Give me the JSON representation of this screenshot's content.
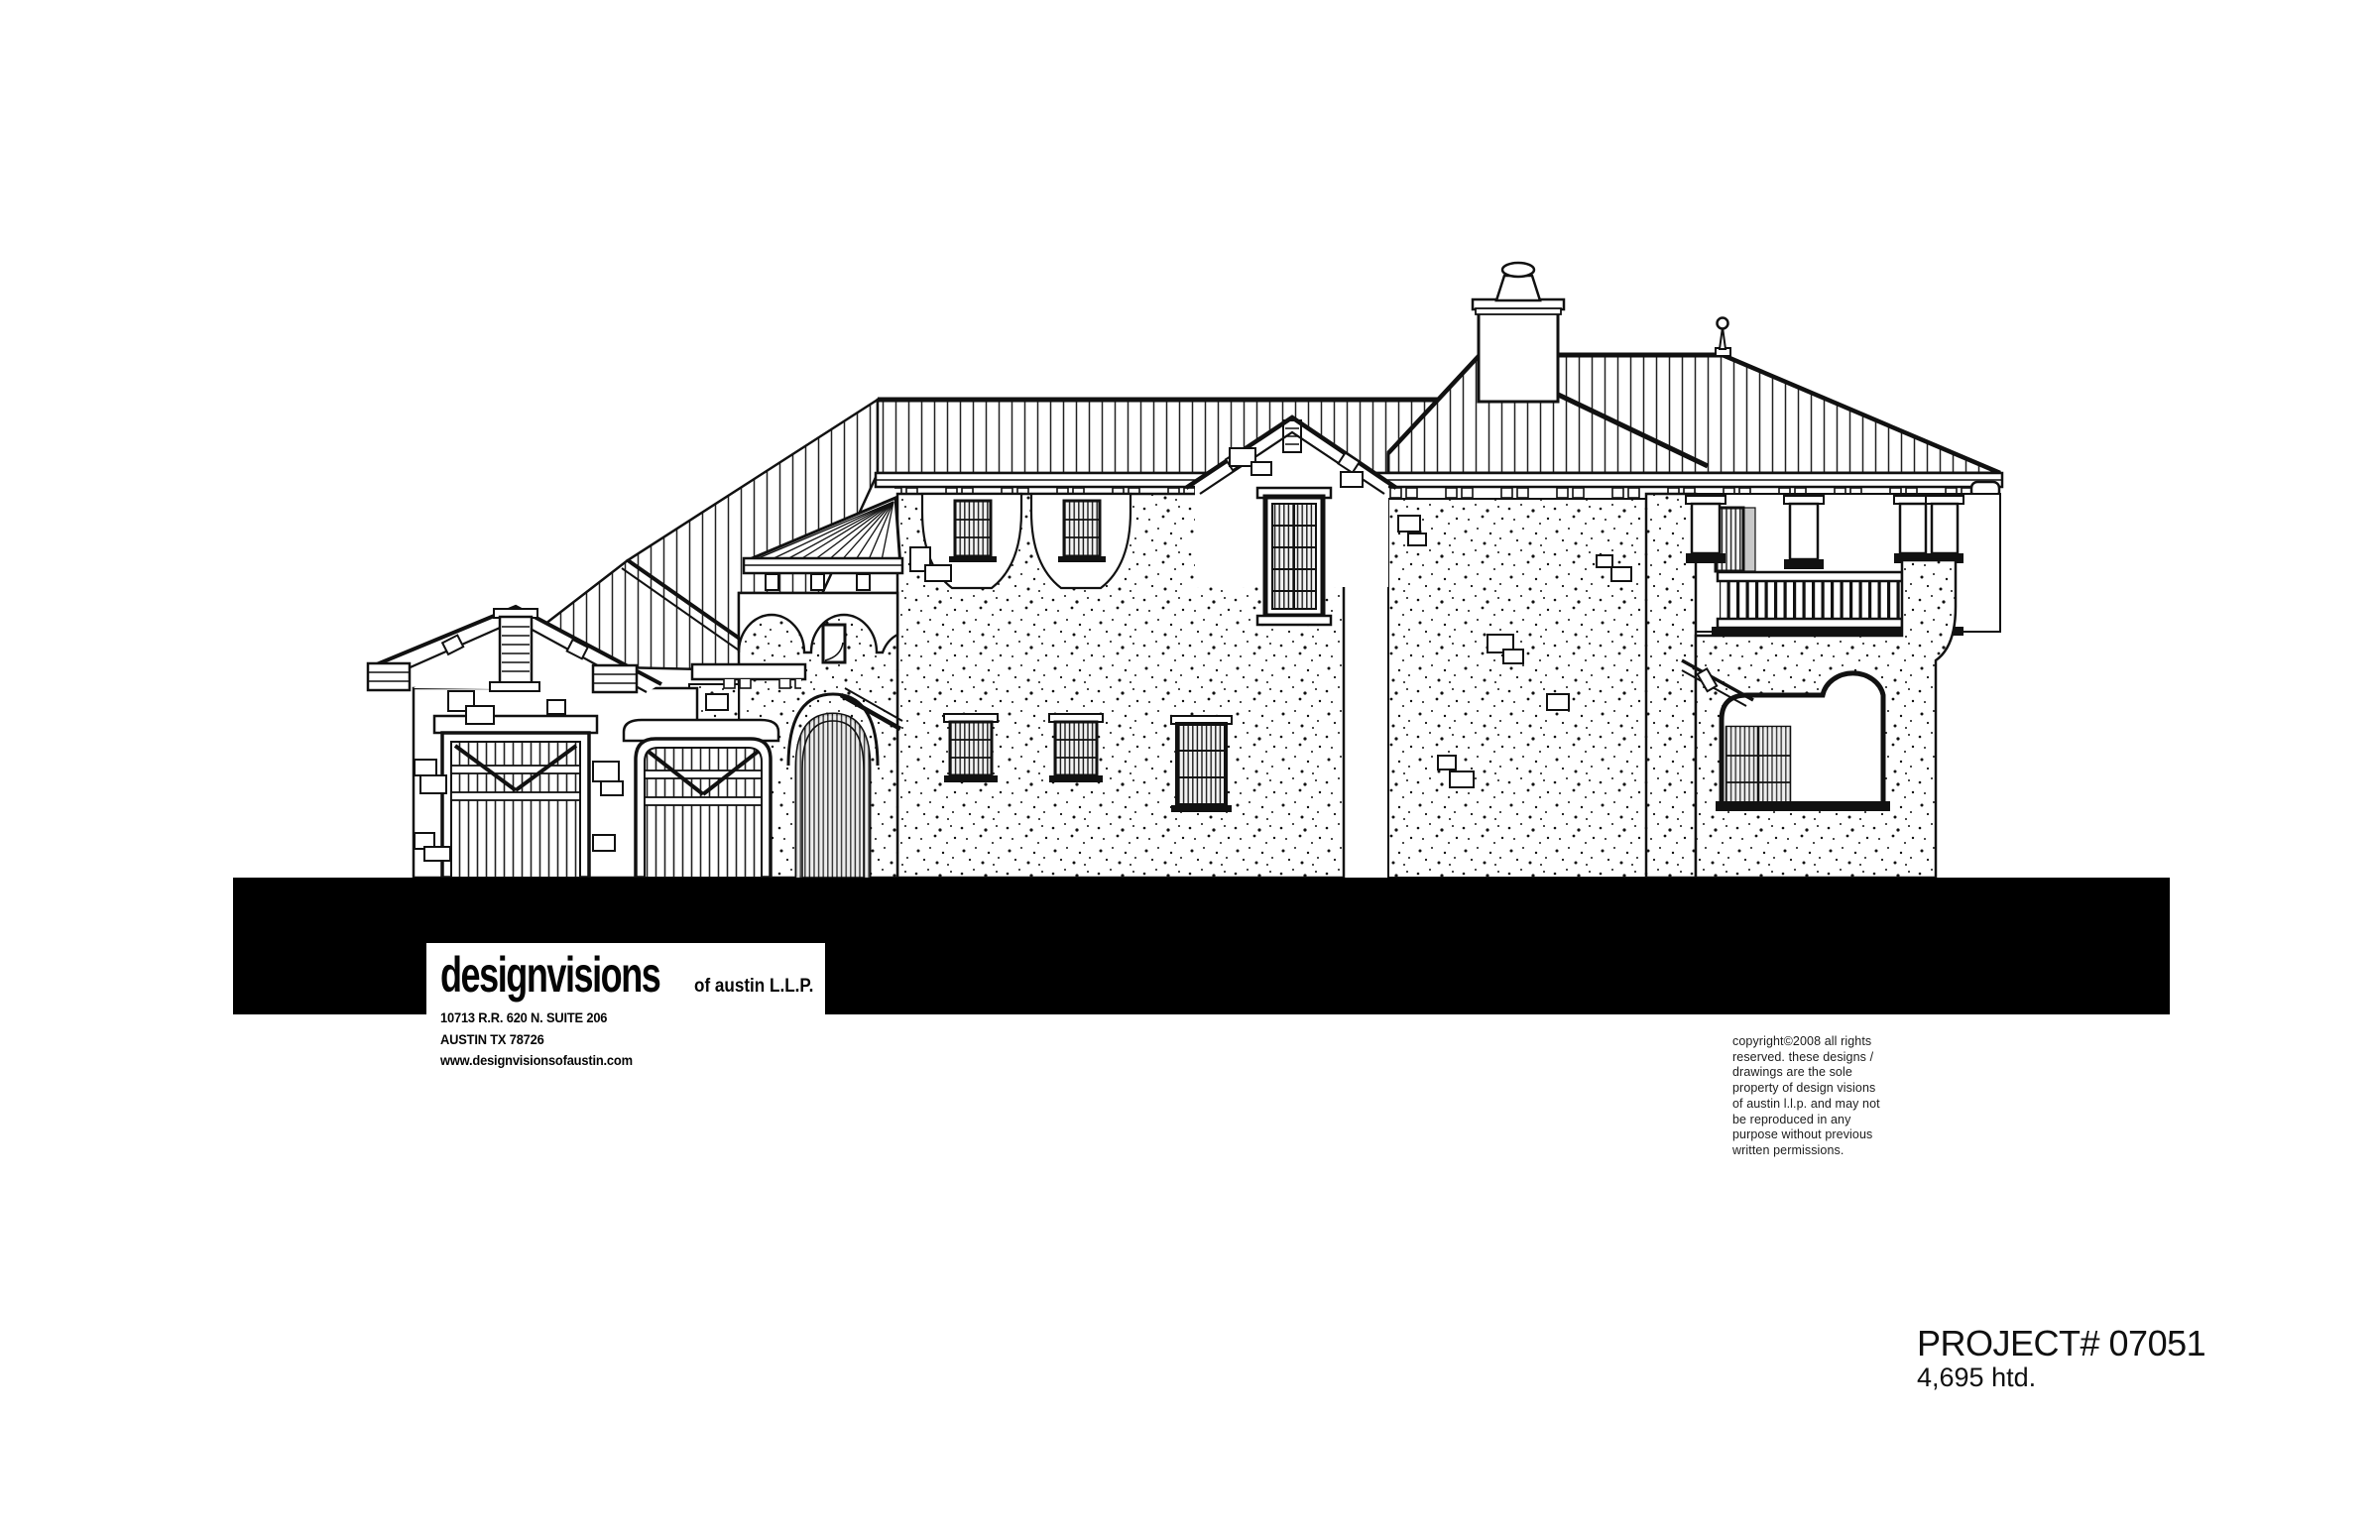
{
  "page": {
    "background": "#ffffff",
    "ink": "#111111",
    "ground_band_color": "#000000"
  },
  "drawing": {
    "type": "architectural-elevation",
    "description": "Side elevation of a two-story Mediterranean style residence",
    "features": [
      "standing-seam-metal-roof",
      "stucco-stipple-walls",
      "stone-accents",
      "garage-doors",
      "turret-with-conical-roof",
      "arched-entry",
      "chimney",
      "roof-finial",
      "balcony-with-columns",
      "covered-porch",
      "arched-window-recesses"
    ]
  },
  "title_block": {
    "logo_main": "designvisions",
    "logo_suffix": "of austin L.L.P.",
    "address_lines": [
      "10713 R.R. 620 N. SUITE 206",
      "AUSTIN TX 78726",
      "www.designvisionsofaustin.com"
    ]
  },
  "copyright": {
    "lines": [
      "copyright©2008 all rights",
      "reserved.  these designs /",
      "drawings are the sole",
      "property of design visions",
      "of austin l.l.p. and may not",
      "be reproduced in any",
      "purpose without previous",
      "written permissions."
    ]
  },
  "project": {
    "number": "PROJECT# 07051",
    "area": "4,695 htd."
  }
}
